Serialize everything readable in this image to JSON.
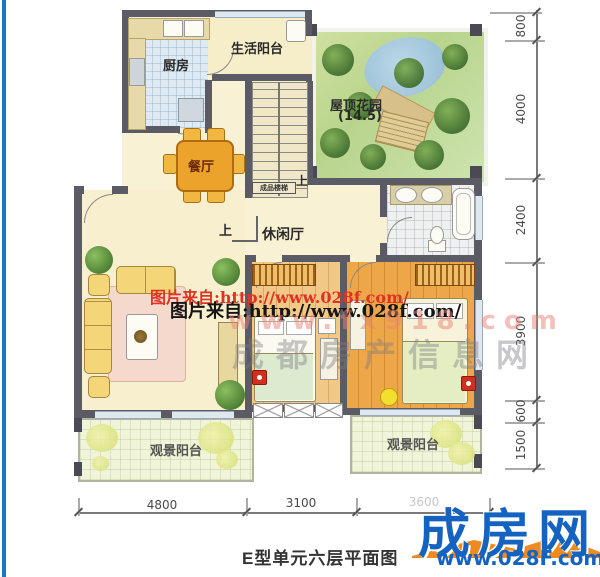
{
  "plan": {
    "labels": {
      "kitchen": "厨房",
      "living_balcony": "生活阳台",
      "roof_garden": "屋顶花园",
      "roof_garden_area": "(14.5)",
      "dining": "餐厅",
      "stairs": "成品楼梯",
      "up_stairs": "上",
      "up_hall": "上",
      "leisure": "休闲厅",
      "balcony_left": "观景阳台",
      "balcony_right": "观景阳台"
    },
    "dimensions": {
      "right": [
        "800",
        "4000",
        "2400",
        "3900",
        "600",
        "1500"
      ],
      "bottom": [
        "4800",
        "3100",
        "3600"
      ]
    }
  },
  "watermarks": {
    "source_line_red": "图片来自:http://www.028f.com/",
    "source_line_black": "图片来自:http://www.028f.com/",
    "faint_url": "www.fx918.com",
    "faint_site_name": "成都房产信息网"
  },
  "footer": {
    "caption": "E型单元六层平面图",
    "logo_name": "成房网",
    "logo_url": "www.028F.com"
  },
  "colors": {
    "logo_blue": "#1563c0",
    "logo_orange": "#ee8a20",
    "watermark_red": "#e03222",
    "wall": "#5b5b66",
    "floor_cream": "#f9f1d3",
    "bedroom_wood": "#efa94a",
    "left_stripe": "#1878c8"
  }
}
